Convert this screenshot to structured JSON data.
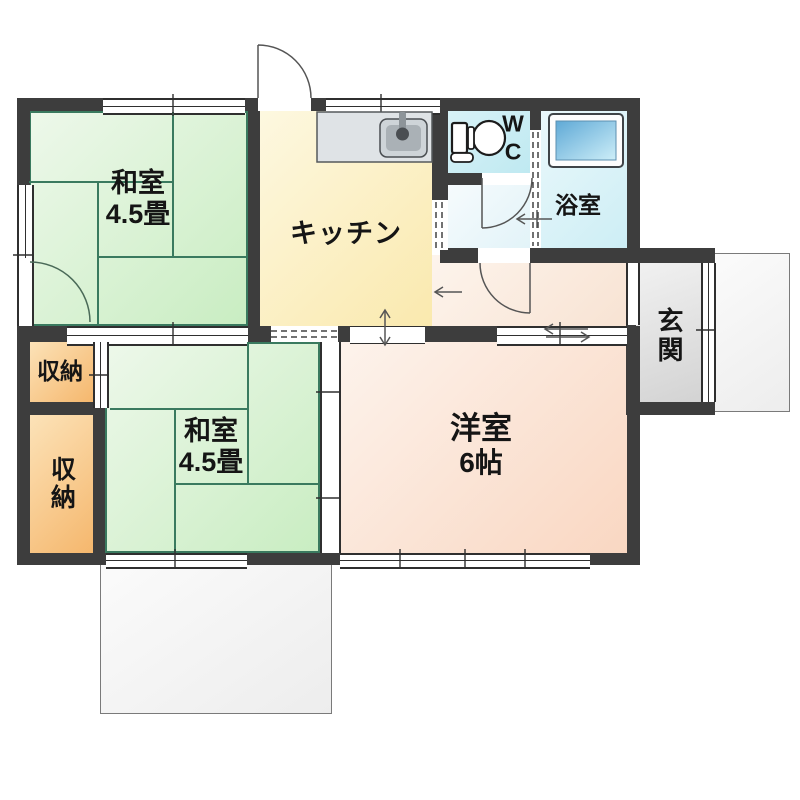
{
  "plan_title": "1DK floor plan",
  "rooms": {
    "washitsu1": {
      "name": "和室",
      "size": "4.5畳"
    },
    "washitsu2": {
      "name": "和室",
      "size": "4.5畳"
    },
    "kitchen": {
      "name": "キッチン"
    },
    "western": {
      "name": "洋室",
      "size": "6帖"
    },
    "wc": {
      "letters": [
        "W",
        "C"
      ]
    },
    "bath": {
      "name": "浴室"
    },
    "entrance": {
      "name": "玄関"
    },
    "storage_upper": {
      "name": "収納"
    },
    "storage_lower": {
      "name": "収納"
    }
  },
  "icons": {
    "toilet": "toilet-icon",
    "bathtub": "bathtub-icon",
    "kitchen_sink": "kitchen-sink-icon"
  },
  "palette": {
    "wall": "#3d3d3d",
    "tatami_line": "#3a7a5f",
    "washitsu_fill": "#c9edc2",
    "kitchen_fill": "#fae9ae",
    "wc_fill": "#bfe9f1",
    "bath_fill": "#cdeef5",
    "western_fill": "#f9d7c2",
    "entrance_fill": "#d3d3d3",
    "storage_fill": "#f5b76d",
    "tub_blue": "#6db3dc"
  }
}
